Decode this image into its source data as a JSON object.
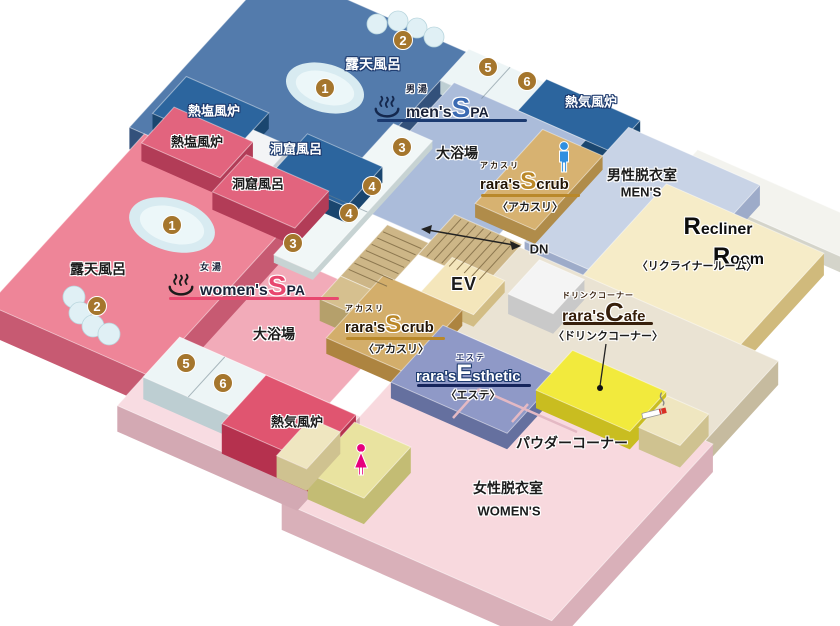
{
  "mens": {
    "spa_tag": "男湯",
    "spa_prefix": "men's",
    "spa_big": "S",
    "spa_suffix": "PA",
    "open_air_bath": "露天風呂",
    "hot_salt_bath": "熱塩風炉",
    "cave_bath": "洞窟風呂",
    "main_bath": "大浴場",
    "hot_air_bath": "熱気風炉",
    "dressing_room": "男性脱衣室",
    "dressing_room_en": "MEN'S"
  },
  "womens": {
    "spa_tag": "女湯",
    "spa_prefix": "women's",
    "spa_big": "S",
    "spa_suffix": "PA",
    "open_air_bath": "露天風呂",
    "hot_salt_bath": "熱塩風炉",
    "cave_bath": "洞窟風呂",
    "main_bath": "大浴場",
    "hot_air_bath": "熱気風炉",
    "dressing_room": "女性脱衣室",
    "dressing_room_en": "WOMEN'S"
  },
  "facilities": {
    "scrub": {
      "tag": "アカスリ",
      "prefix": "rara's",
      "big": "S",
      "suffix": "crub",
      "sub": "〈アカスリ〉"
    },
    "esthetic": {
      "tag": "エステ",
      "prefix": "rara's",
      "big": "E",
      "suffix": "sthetic",
      "sub": "〈エステ〉"
    },
    "cafe": {
      "tag": "ドリンクコーナー",
      "prefix": "rara's",
      "big": "C",
      "suffix": "afe",
      "sub": "〈ドリンクコーナー〉"
    },
    "recliner": {
      "big1": "R",
      "rest1": "ecliner",
      "big2": "R",
      "rest2": "oom",
      "sub": "〈リクライナールーム〉"
    },
    "powder_corner": "パウダーコーナー",
    "elevator": "EV",
    "down": "DN"
  },
  "badges": {
    "men": [
      "1",
      "2",
      "3",
      "4",
      "5",
      "6"
    ],
    "women": [
      "1",
      "2",
      "3",
      "4",
      "5",
      "6"
    ]
  },
  "colors": {
    "mens_accent": "#2c659e",
    "womens_accent": "#e8486f",
    "scrub_accent": "#b9882a",
    "esthetic_accent": "#16255c",
    "cafe_accent": "#371f0b",
    "badge": "#a5762d"
  }
}
